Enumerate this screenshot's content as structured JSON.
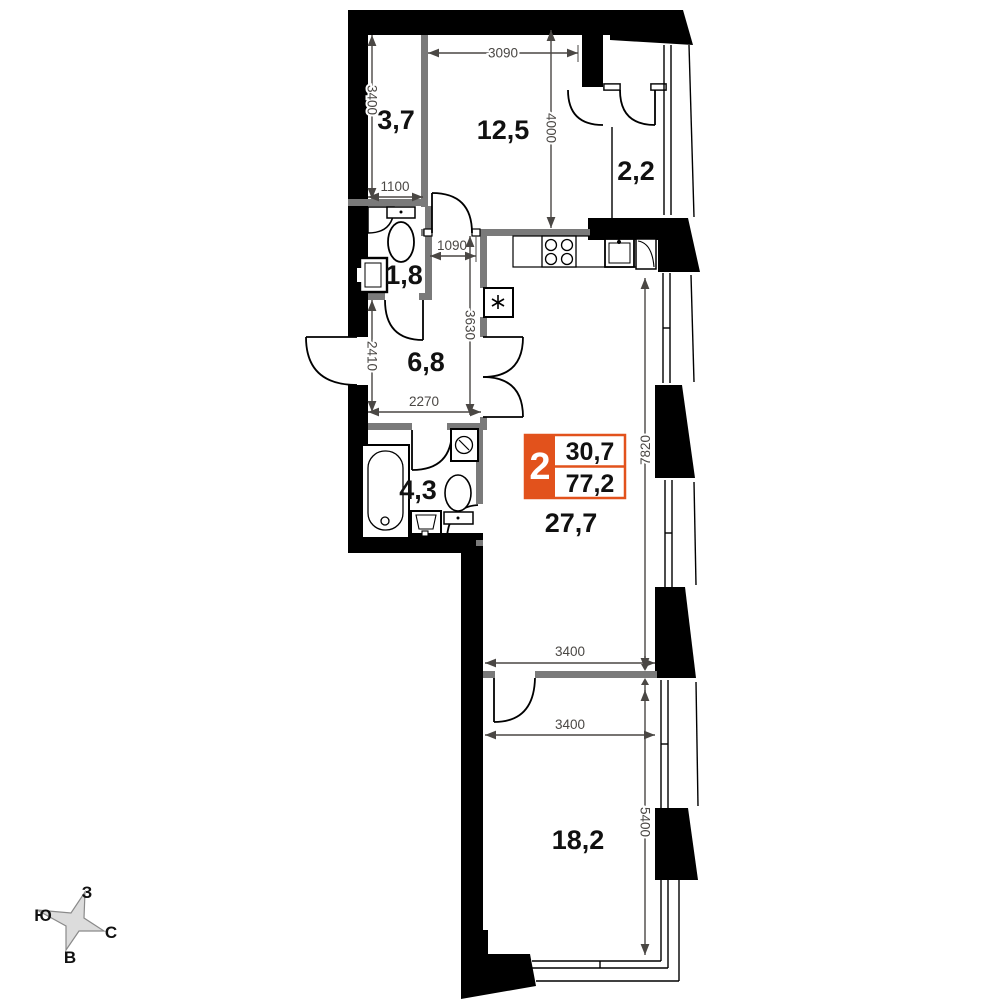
{
  "rooms": [
    {
      "name": "entry-hall",
      "label": "3,7"
    },
    {
      "name": "bedroom",
      "label": "12,5"
    },
    {
      "name": "balcony",
      "label": "2,2"
    },
    {
      "name": "wc",
      "label": "1,8"
    },
    {
      "name": "hallway",
      "label": "6,8"
    },
    {
      "name": "bathroom",
      "label": "4,3"
    },
    {
      "name": "kitchen-living-room",
      "label": "27,7"
    },
    {
      "name": "bedroom-2",
      "label": "18,2"
    }
  ],
  "dimensions_mm": [
    {
      "name": "dim-3400-left",
      "value": "3400"
    },
    {
      "name": "dim-3090-top",
      "value": "3090"
    },
    {
      "name": "dim-4000-room",
      "value": "4000"
    },
    {
      "name": "dim-1100",
      "value": "1100"
    },
    {
      "name": "dim-1090",
      "value": "1090"
    },
    {
      "name": "dim-3630",
      "value": "3630"
    },
    {
      "name": "dim-2410",
      "value": "2410"
    },
    {
      "name": "dim-2270",
      "value": "2270"
    },
    {
      "name": "dim-7820",
      "value": "7820"
    },
    {
      "name": "dim-3400-upper",
      "value": "3400"
    },
    {
      "name": "dim-3400-lower",
      "value": "3400"
    },
    {
      "name": "dim-5400",
      "value": "5400"
    }
  ],
  "badge": {
    "rooms_count": "2",
    "area_value_top": "30,7",
    "area_value_bottom": "77,2",
    "accent_color": "#e2521c"
  },
  "compass": {
    "west": "З",
    "south": "Ю",
    "north": "С",
    "east": "В"
  },
  "fixtures": [
    "bathtub",
    "toilet",
    "washing-machine",
    "sink",
    "corner-sink",
    "water-heater",
    "stove",
    "kitchen-sink",
    "fridge"
  ],
  "colors": {
    "wall": "#000000",
    "partition": "#7a7a7a",
    "dimension": "#4a4744",
    "label": "#111111",
    "compass_fill": "#dcdcdc",
    "compass_stroke": "#8a8a8a"
  }
}
